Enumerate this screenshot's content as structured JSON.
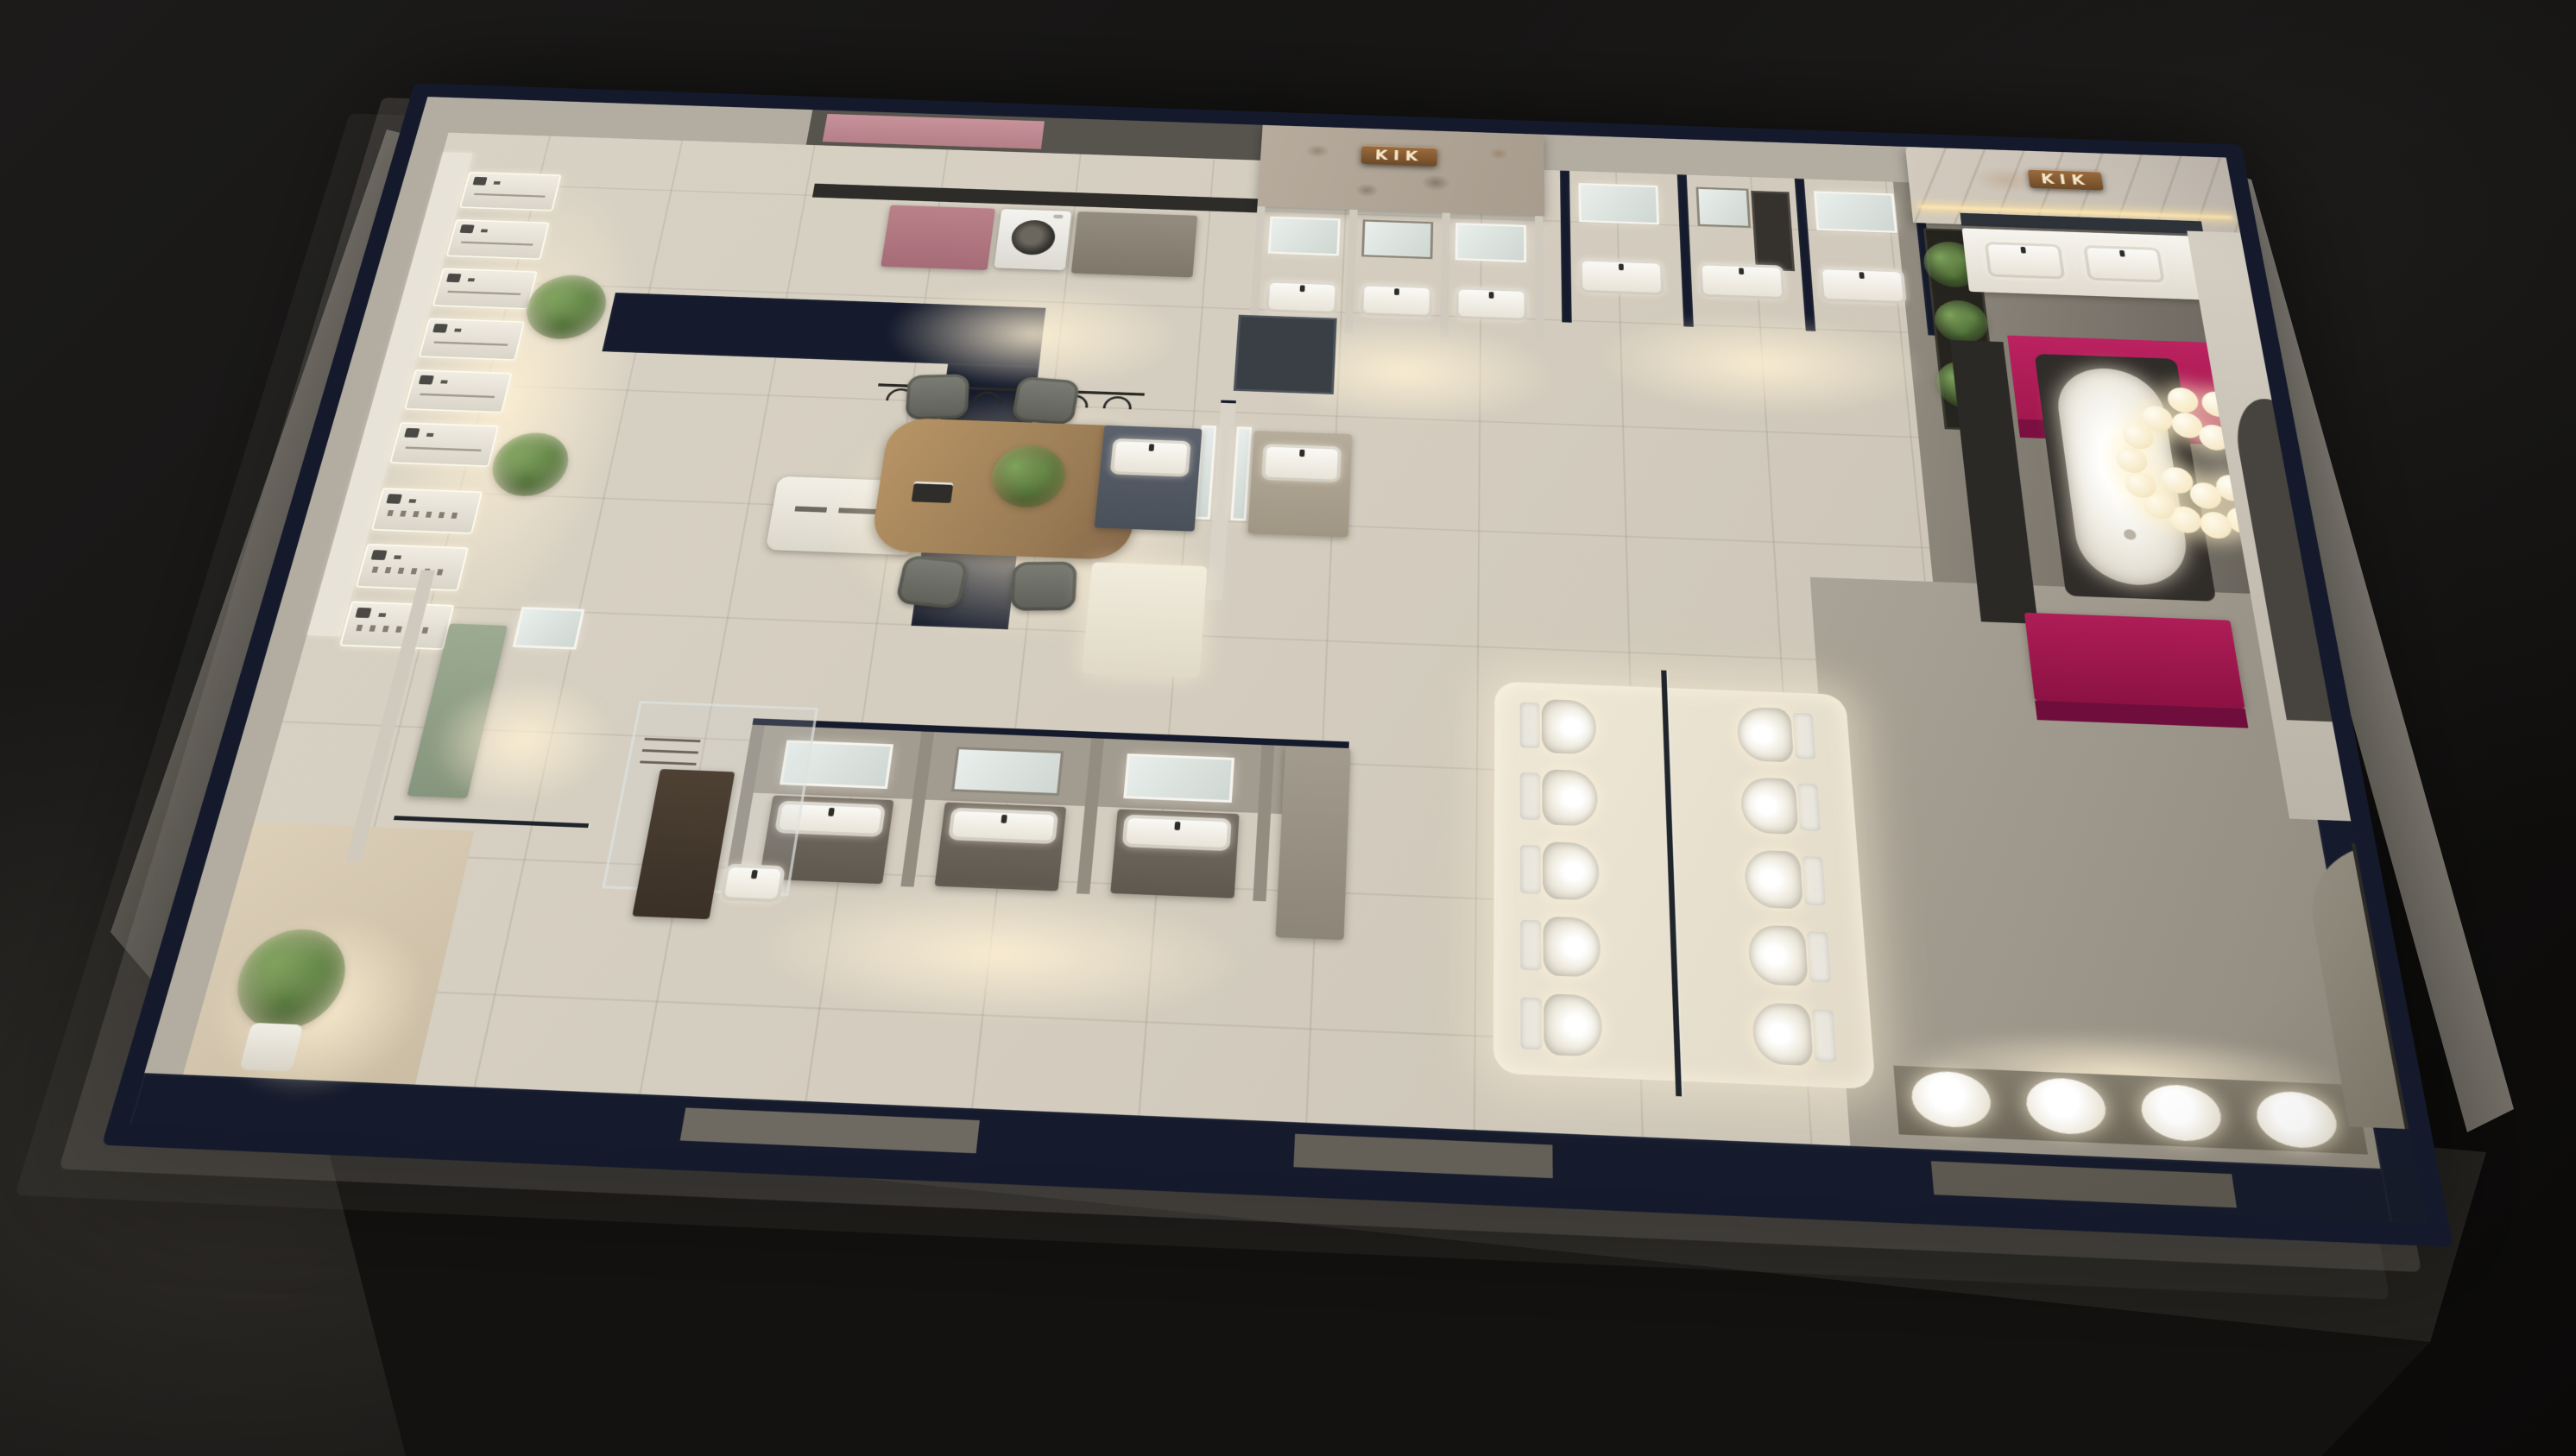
{
  "scene": {
    "title": "Bathroom showroom 3D floor-plan render (night dollhouse view)",
    "background_color": "#121110",
    "signs": [
      {
        "text": "KIK",
        "style": "bronze plaque",
        "location": "stone feature wall, top-center"
      },
      {
        "text": "KIK",
        "style": "bronze plaque",
        "location": "marble feature wall, top-right"
      }
    ],
    "palette": {
      "wall_top_navy": "#151b2c",
      "wall_face_gray": "#b2aca1",
      "floor_beige": "#d6d0c3",
      "floor_dark": "#474440",
      "accent_magenta": "#a81a52",
      "accent_rose": "#c18b92",
      "sage_green": "#93a188",
      "bronze_sign": "#8a5a33",
      "led_warm": "#ffe8b0",
      "plant_green": "#5c8140",
      "wood_oak": "#a98a63",
      "fixture_white": "#f4f2ec"
    },
    "fixtures": {
      "shower_display_panels": 9,
      "vanity_stations": 11,
      "toilets_on_display": 10,
      "front_row_basins": 4,
      "freestanding_bathtubs": 1,
      "washing_machines": 1,
      "consultation_chairs": 4,
      "chandelier_bubbles": 20,
      "plants": 6
    }
  },
  "areas": [
    {
      "id": "shower-display",
      "label": "Shower fixture display wall"
    },
    {
      "id": "laundry-display",
      "label": "Laundry corner with washing machine"
    },
    {
      "id": "stone-feature-wall",
      "label": "Stone feature wall with KIK sign"
    },
    {
      "id": "vanity-gallery-north",
      "label": "North vanity bays with mirrors"
    },
    {
      "id": "plant-wall",
      "label": "Greenery shelf wall"
    },
    {
      "id": "master-bath-display",
      "label": "Marble master bath with double vanity"
    },
    {
      "id": "bathtub-stage",
      "label": "Magenta platform with freestanding tub and bubble chandelier"
    },
    {
      "id": "consultation-area",
      "label": "Wood consultation table with chairs"
    },
    {
      "id": "twin-vanity-island",
      "label": "Back-to-back vanity units"
    },
    {
      "id": "vanity-bays-south",
      "label": "South vanity bays"
    },
    {
      "id": "glass-shower-room",
      "label": "Glass shower enclosure room"
    },
    {
      "id": "sage-room",
      "label": "Sage cabinet display room"
    },
    {
      "id": "toilet-display",
      "label": "Toilet display platform, 2 rows of 5"
    },
    {
      "id": "basin-row",
      "label": "Front wall basin row"
    },
    {
      "id": "entrance",
      "label": "Entrance nook with olive plant"
    }
  ]
}
